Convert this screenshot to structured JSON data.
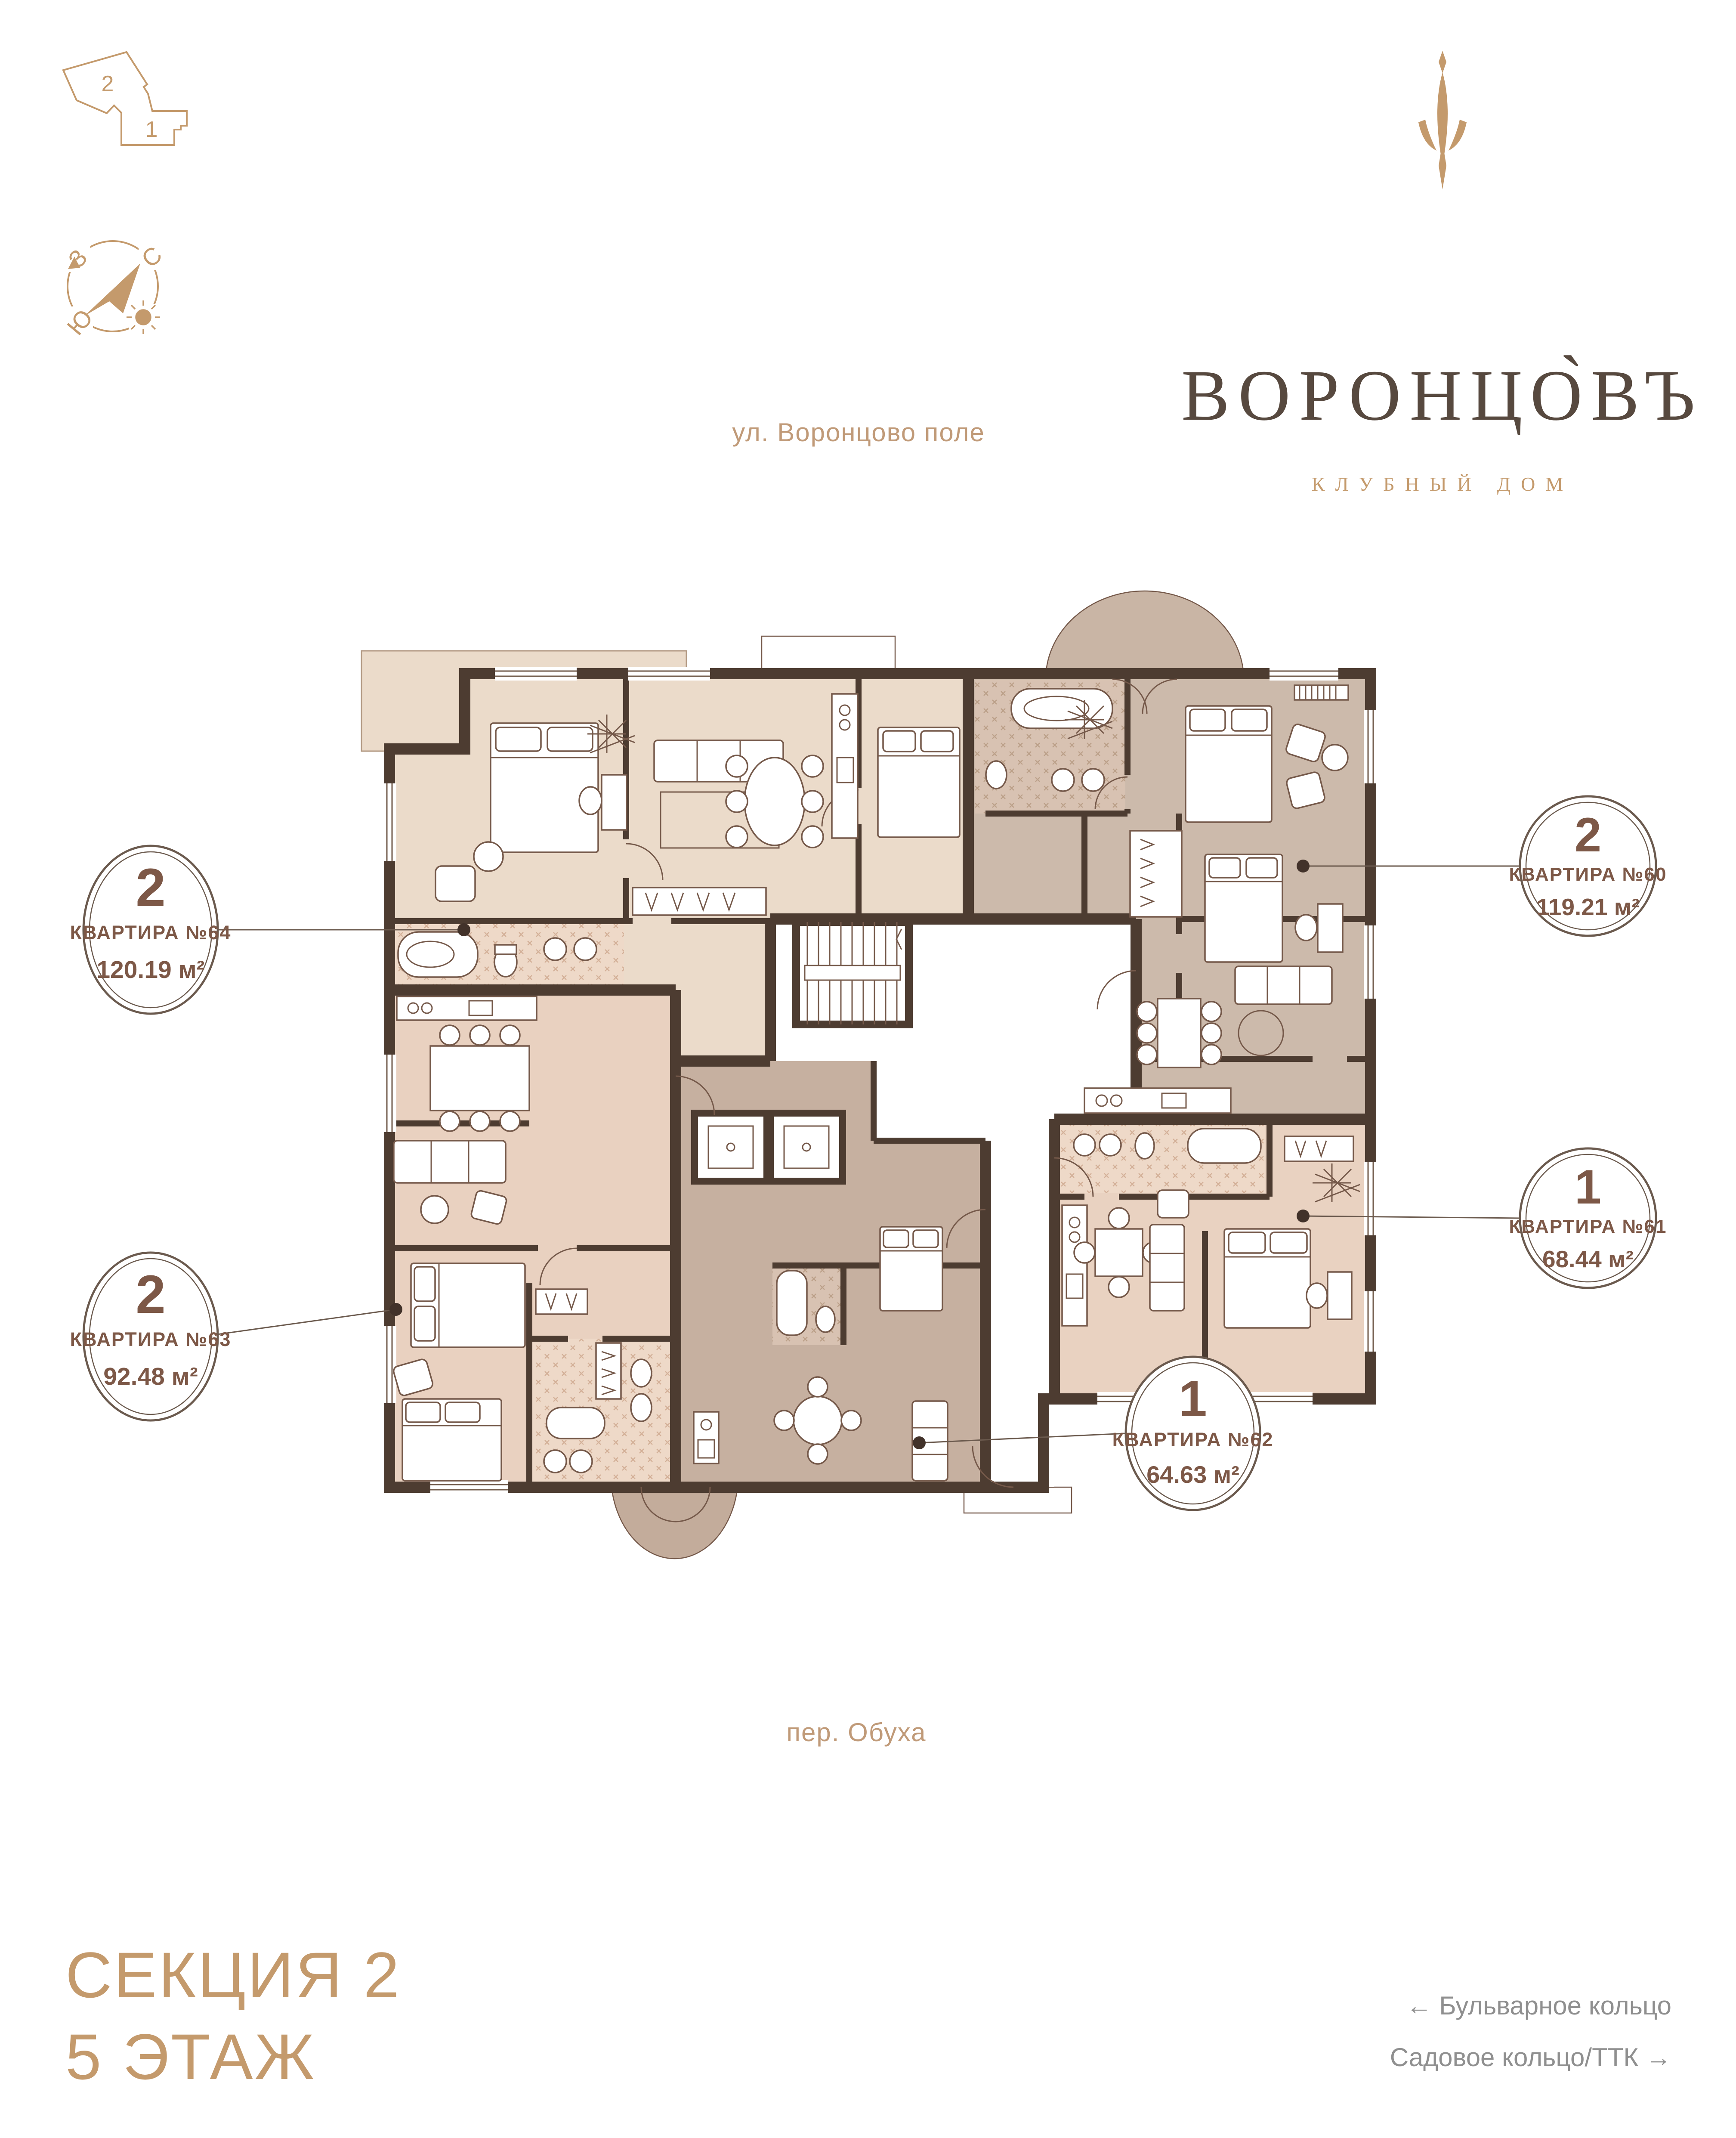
{
  "logo": {
    "title": "ВОРОНЦО̀ВЪ",
    "subtitle": "КЛУБНЫЙ ДОМ"
  },
  "minimap": {
    "section2_label": "2",
    "section1_label": "1"
  },
  "compass": {
    "north": "С",
    "west": "З",
    "south": "Ю"
  },
  "streets": {
    "top": "ул. Воронцово поле",
    "bottom": "пер. Обуха"
  },
  "apartments": {
    "a64": {
      "rooms": "2",
      "label": "КВАРТИРА №64",
      "area": "120.19 м²"
    },
    "a60": {
      "rooms": "2",
      "label": "КВАРТИРА №60",
      "area": "119.21 м²"
    },
    "a63": {
      "rooms": "2",
      "label": "КВАРТИРА №63",
      "area": "92.48 м²"
    },
    "a61": {
      "rooms": "1",
      "label": "КВАРТИРА №61",
      "area": "68.44 м²"
    },
    "a62": {
      "rooms": "1",
      "label": "КВАРТИРА №62",
      "area": "64.63 м²"
    }
  },
  "footer": {
    "section": "СЕКЦИЯ 2",
    "floor": "5 ЭТАЖ",
    "direction_left": "← Бульварное кольцо",
    "direction_right": "Садовое кольцо/ТТК →"
  },
  "colors": {
    "accent": "#c49a6c",
    "callout_brown": "#7d5847",
    "wall": "#4d3c31",
    "floor_apt64": "#ebdbca",
    "floor_apt60": "#ccbaab",
    "floor_apt63": "#e9d1c0",
    "floor_apt62": "#c6b0a0",
    "floor_apt61": "#e9d2c1",
    "direction_gray": "#8f8f8f"
  }
}
